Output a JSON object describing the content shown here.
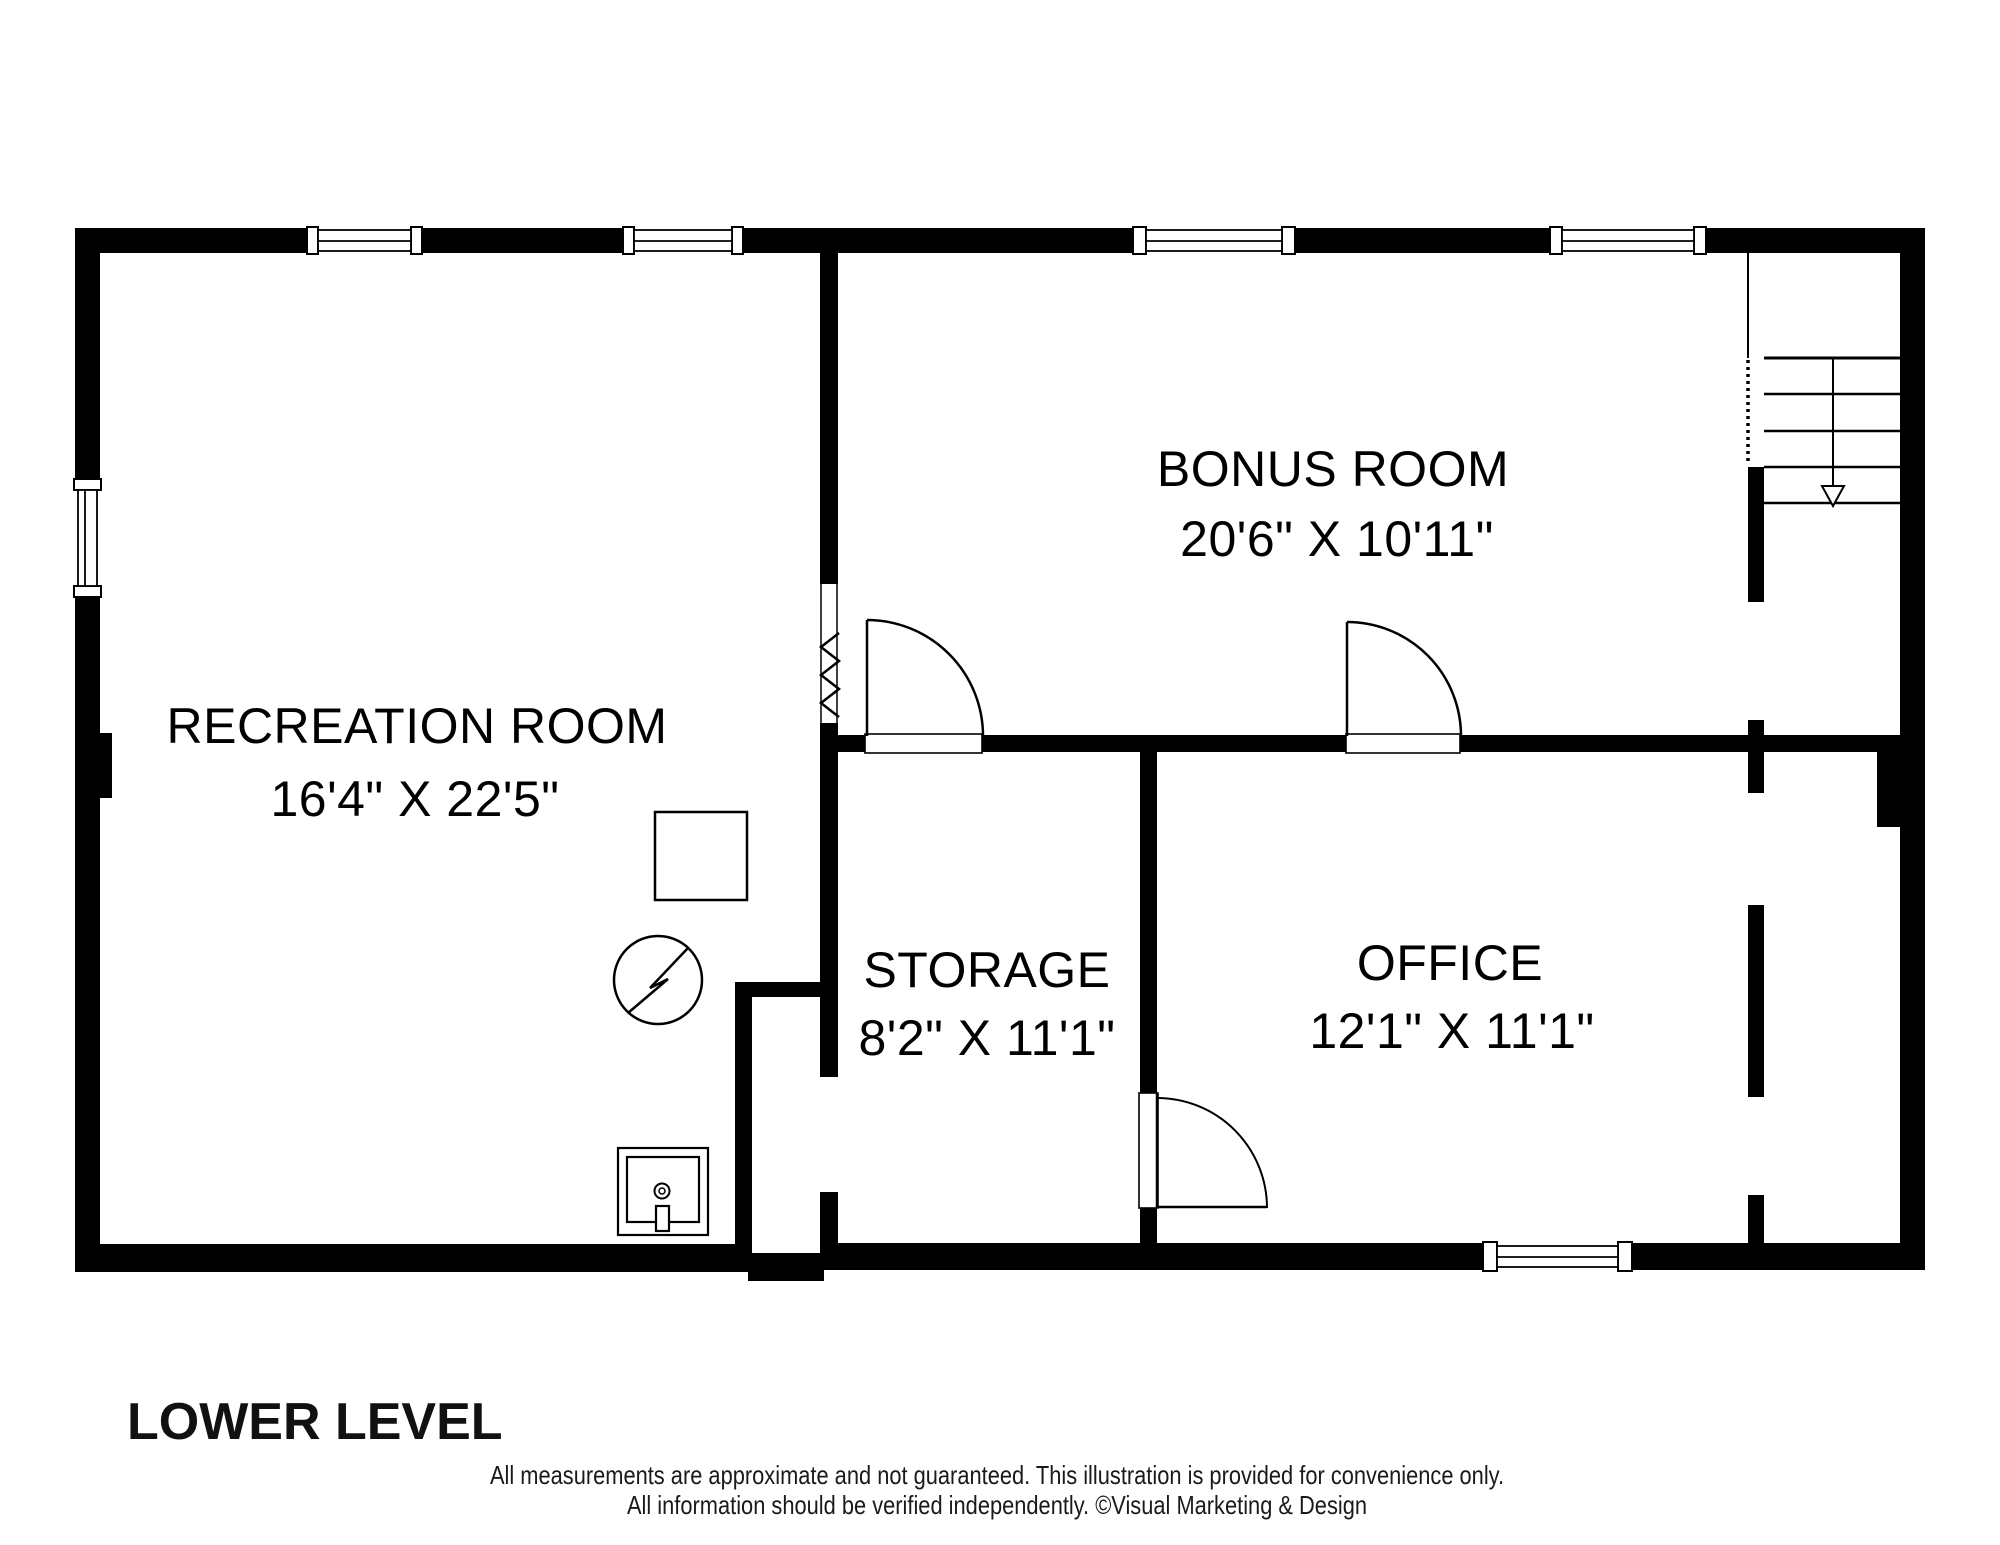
{
  "floor": {
    "title": "LOWER LEVEL"
  },
  "rooms": {
    "recreation": {
      "name": "RECREATION ROOM",
      "dims": "16'4\" X 22'5\""
    },
    "bonus": {
      "name": "BONUS ROOM",
      "dims": "20'6\" X 10'11\""
    },
    "storage": {
      "name": "STORAGE",
      "dims": "8'2\" X 11'1\""
    },
    "office": {
      "name": "OFFICE",
      "dims": "12'1\" X 11'1\""
    }
  },
  "footer": {
    "line1": "All measurements are approximate and not guaranteed. This illustration is provided for convenience only.",
    "line2": "All information should be verified independently. ©Visual Marketing & Design"
  },
  "colors": {
    "wall": "#000000",
    "background": "#ffffff",
    "text": "#000000"
  },
  "symbols": {
    "stairs": "stairs-down-arrow",
    "meter": "electric-meter-symbol",
    "sink": "utility-sink",
    "furnace": "furnace-square",
    "opening": "wall-break-zigzag"
  }
}
